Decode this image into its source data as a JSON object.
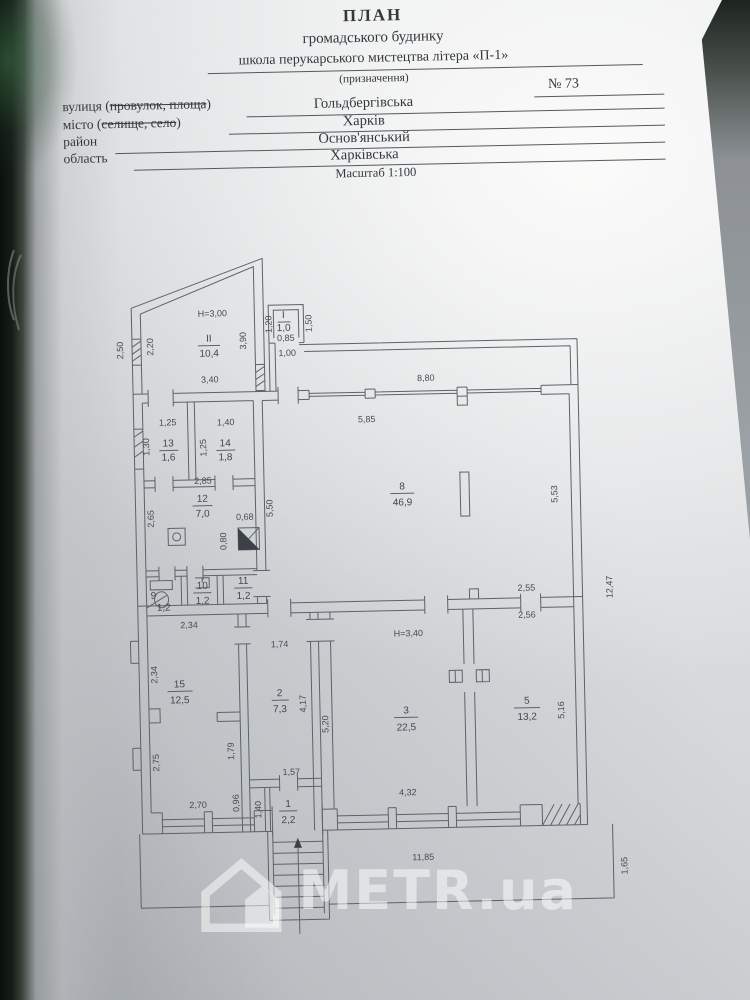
{
  "header": {
    "title": "ПЛАН",
    "subtitle": "громадського будинку",
    "object_name": "школа перукарського мистецтва  літера «П-1»",
    "object_caption": "(призначення)",
    "house_number": "№ 73",
    "street_label_pre": "вулиця (",
    "street_label_struck": "провулок, площа",
    "street_label_post": ")",
    "street_value": "Гольдбергівська",
    "city_label_pre": "місто (",
    "city_label_struck": "селище, село",
    "city_label_post": ")",
    "city_value": "Харків",
    "district_label": "район",
    "district_value": "Основ'янський",
    "region_label": "область",
    "region_value": "Харківська",
    "scale": "Масштаб 1:100"
  },
  "plan": {
    "heights": {
      "upper": "Н=3,00",
      "lower": "Н=3,40"
    },
    "rooms": {
      "top2": {
        "num": "ІІ",
        "area": "10,4"
      },
      "top1": {
        "num": "І",
        "area": "1,0"
      },
      "r13": {
        "num": "13",
        "area": "1,6"
      },
      "r14": {
        "num": "14",
        "area": "1,8"
      },
      "r12": {
        "num": "12",
        "area": "7,0"
      },
      "r9": {
        "num": "9",
        "area": "1,2"
      },
      "r10": {
        "num": "10",
        "area": "1,2"
      },
      "r11": {
        "num": "11",
        "area": "1,2"
      },
      "r8": {
        "num": "8",
        "area": "46,9"
      },
      "r15": {
        "num": "15",
        "area": "12,5"
      },
      "r2": {
        "num": "2",
        "area": "7,3"
      },
      "r1": {
        "num": "1",
        "area": "2,2"
      },
      "r3": {
        "num": "3",
        "area": "22,5"
      },
      "r5": {
        "num": "5",
        "area": "13,2"
      }
    },
    "dims": [
      "2,50",
      "2,20",
      "3,90",
      "1,20",
      "1,50",
      "0,85",
      "1,00",
      "3,40",
      "8,80",
      "5,85",
      "1,25",
      "1,40",
      "1,30",
      "1,25",
      "2,85",
      "2,65",
      "0,68",
      "0,80",
      "5,50",
      "5,53",
      "2,55",
      "12,47",
      "2,34",
      "2,34",
      "2,75",
      "2,70",
      "1,79",
      "1,74",
      "4,17",
      "5,20",
      "4,32",
      "2,56",
      "5,16",
      "0,96",
      "1,40",
      "1,57",
      "11,85",
      "1,65"
    ]
  },
  "watermark": {
    "text": "METR.ua"
  }
}
